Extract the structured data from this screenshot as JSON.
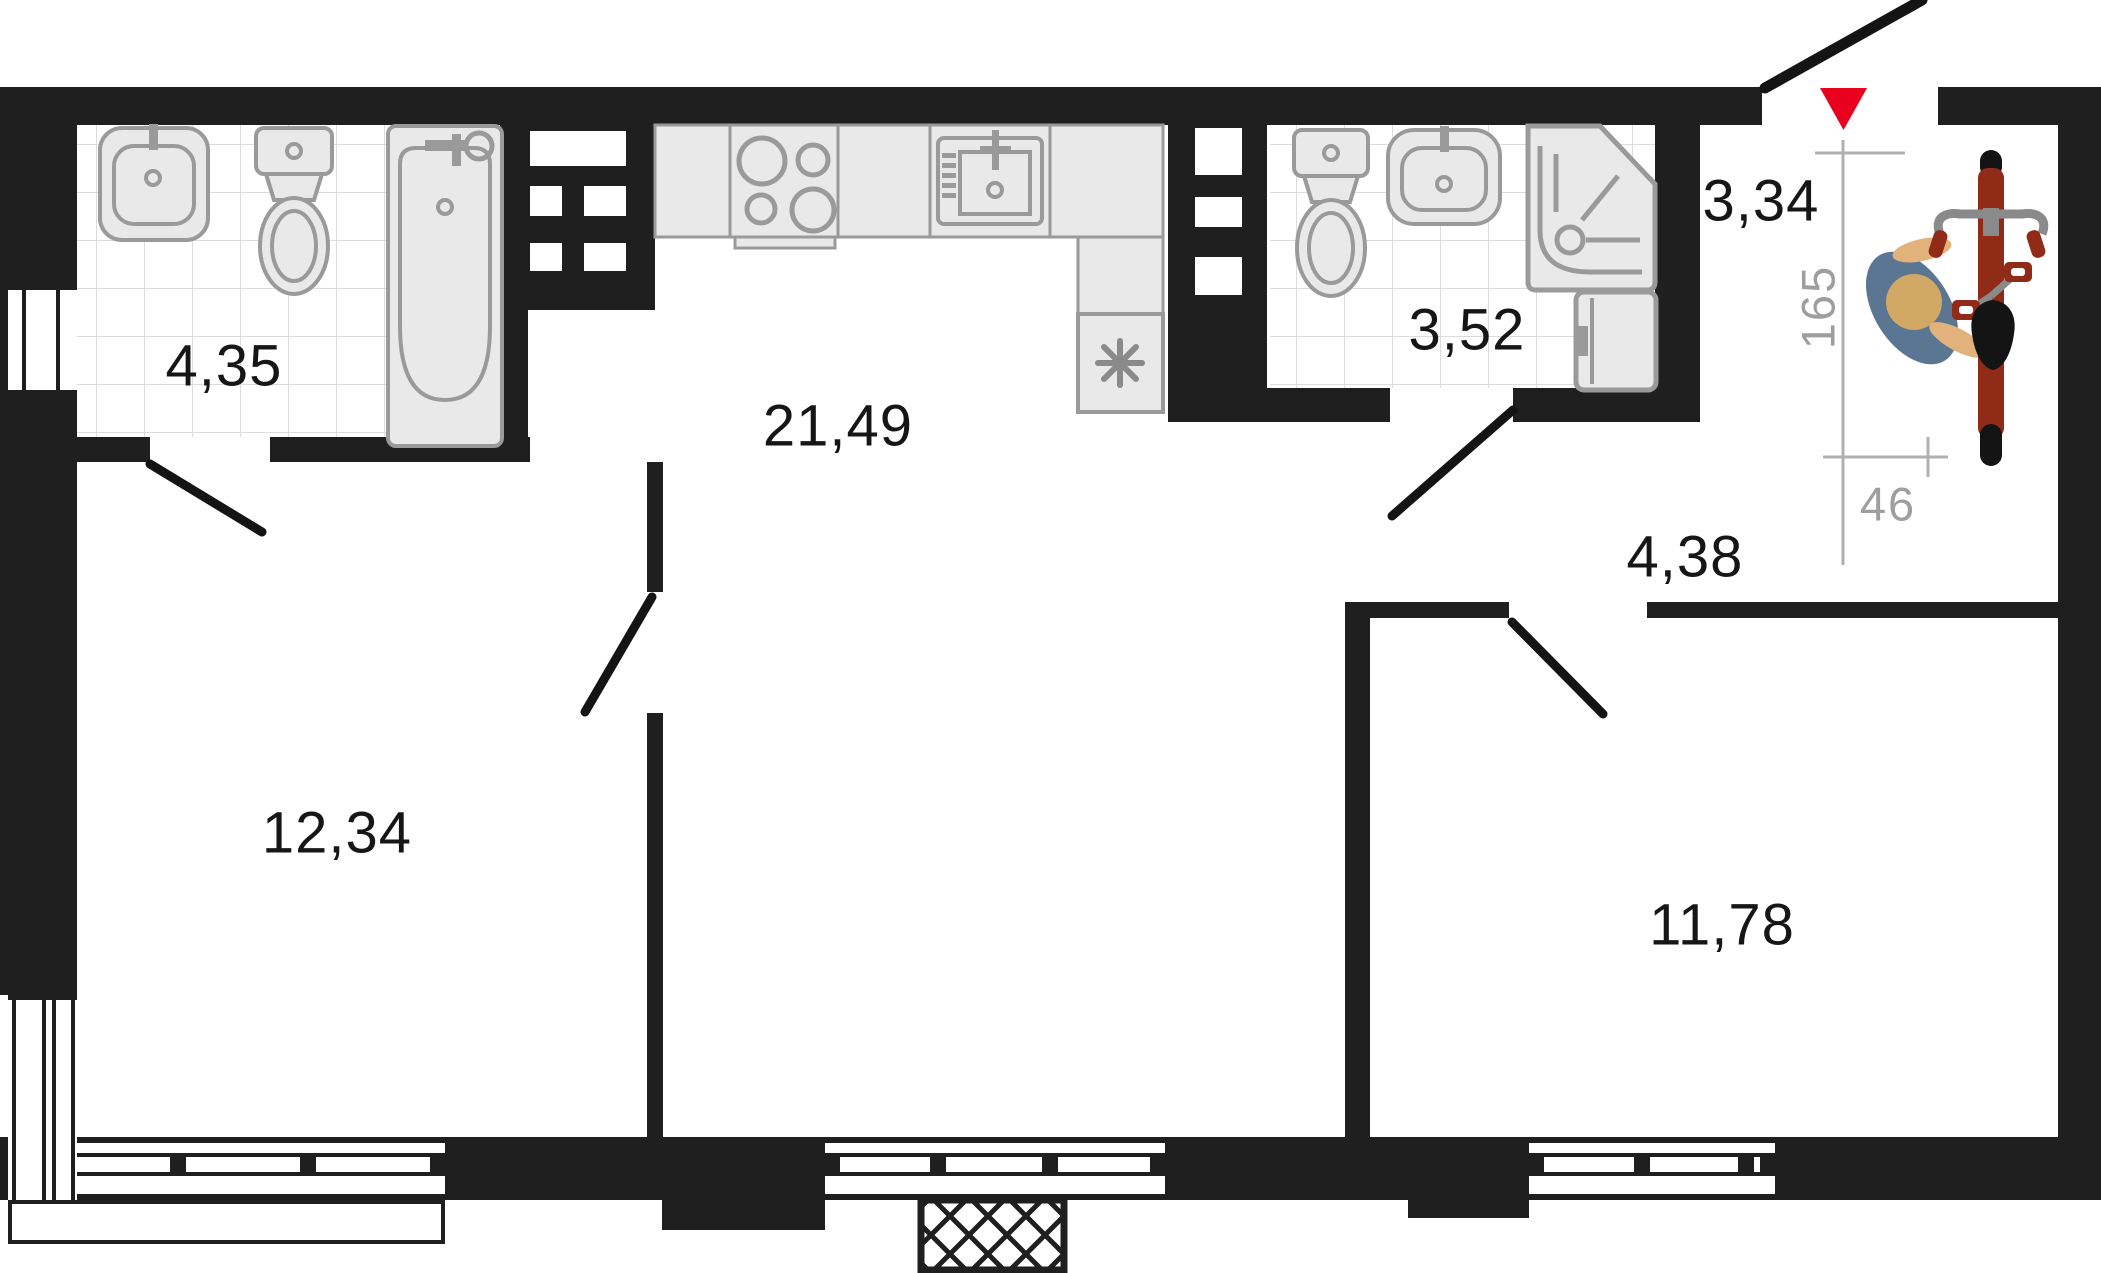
{
  "plan": {
    "title": "Apartment floor plan",
    "rooms": [
      {
        "id": "bathroom-1",
        "area": "4,35"
      },
      {
        "id": "kitchen-living-room",
        "area": "21,49"
      },
      {
        "id": "bathroom-2",
        "area": "3,52"
      },
      {
        "id": "entry",
        "area": "3,34"
      },
      {
        "id": "hallway",
        "area": "4,38"
      },
      {
        "id": "bedroom-1",
        "area": "12,34"
      },
      {
        "id": "bedroom-2",
        "area": "11,78"
      }
    ],
    "dimensions": [
      {
        "id": "bike-nook-depth",
        "value": "165"
      },
      {
        "id": "bike-nook-width",
        "value": "46"
      }
    ],
    "colors": {
      "wall": "#1f1f1f",
      "fixture_fill": "#e9e9e9",
      "fixture_stroke": "#9a9a9a",
      "tile_line": "#dcdcdc",
      "dimension_text": "#9e9e9e",
      "entrance_marker_red": "#e8001c",
      "bike_frame_red": "#8f2b16",
      "person_torso_blue": "#5b7693",
      "person_skin": "#e2b27c",
      "person_head_tan": "#d2a964"
    },
    "icons": [
      "entrance-triangle-icon",
      "entrance-door-swing-icon",
      "bicycle-icon",
      "person-icon",
      "bathtub-icon",
      "toilet-icon",
      "wash-basin-icon",
      "shower-cabin-icon",
      "washing-machine-icon",
      "stove-icon",
      "kitchen-sink-icon",
      "fridge-asterisk-icon",
      "vent-shaft-icon",
      "window-icon",
      "balcony-hatch-icon",
      "door-swing-icon"
    ]
  }
}
